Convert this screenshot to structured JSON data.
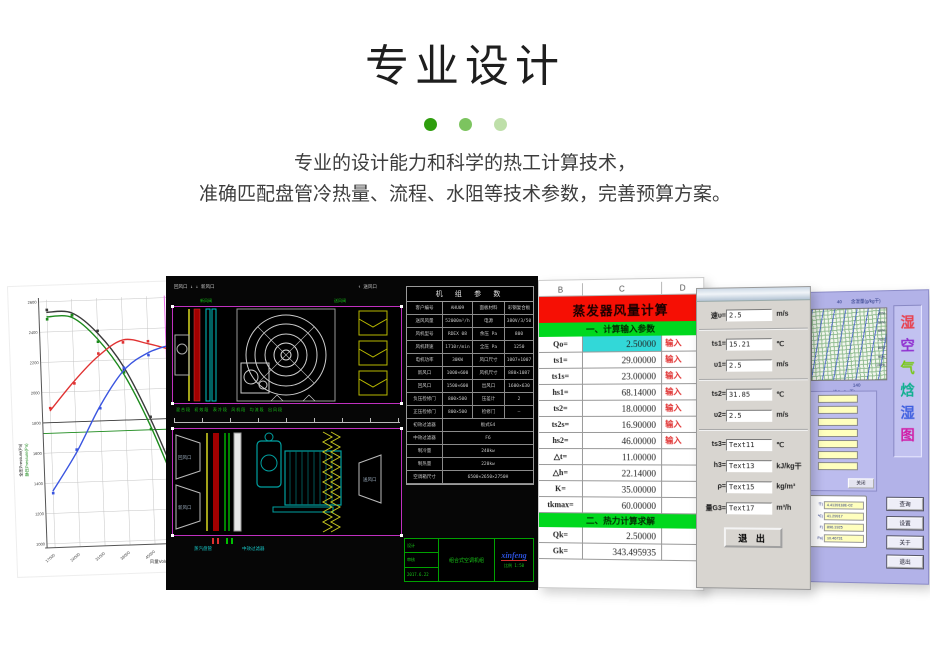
{
  "header": {
    "title": "专业设计",
    "dot_colors": [
      "#2f9e0e",
      "#7cc45f",
      "#bedfa9"
    ],
    "desc_line1": "专业的设计能力和科学的热工计算技术，",
    "desc_line2": "准确匹配盘管冷热量、流程、水阻等技术参数，完善预算方案。"
  },
  "chart_data": {
    "type": "line",
    "title": "风机性能曲线",
    "xlabel": "风量Volume(m³/h)",
    "ylabel_primary": "全压Pressure(Pa)",
    "ylabel_secondary": "静压Pressure(Pa)",
    "x": [
      17000,
      24000,
      31000,
      38000,
      45000,
      52000
    ],
    "x_tick_labels": [
      "17000",
      "24000",
      "31000",
      "38000",
      "45000",
      "52000"
    ],
    "ylim": [
      1000,
      2600
    ],
    "y_ticks": [
      1000,
      1200,
      1400,
      1600,
      1800,
      2000,
      2200,
      2400,
      2600
    ],
    "grid": true,
    "legend_position": "none",
    "series": [
      {
        "name": "全压",
        "color": "#3a3a3a",
        "values": [
          2530,
          2520,
          2380,
          2150,
          1800,
          1380
        ]
      },
      {
        "name": "静压",
        "color": "#1c8a1c",
        "values": [
          2500,
          2490,
          2340,
          2100,
          1750,
          1320
        ]
      },
      {
        "name": "功率",
        "color": "#e03232",
        "values": [
          1880,
          2070,
          2230,
          2330,
          2300,
          2250
        ]
      },
      {
        "name": "效率",
        "color": "#3a55e0",
        "values": [
          1350,
          1600,
          1900,
          2130,
          2240,
          2290
        ]
      }
    ],
    "ref_lines": {
      "horizontal": [
        {
          "y": 1800,
          "color": "#3a3a3a"
        },
        {
          "y": 1730,
          "color": "#1c8a1c"
        }
      ],
      "vertical": [
        {
          "x": 50000,
          "color": "#ea6ae8"
        }
      ]
    }
  },
  "cad": {
    "top_left_label": "回风口 ↓  ↓ 新风口",
    "top_right_label": "↑ 送风口",
    "valve_label_left": "新风阀",
    "valve_label_right": "送风阀",
    "sections_label": "混合段  初效段  表冷段  风机段  均流段  出风段",
    "inlet_label_top": "回风口",
    "inlet_label_bottom": "新风口",
    "outlet_label": "送风口",
    "bottom_label_1": "蒸汽盘管",
    "bottom_label_2": "中效过滤器",
    "table": {
      "title": "机 组 参 数",
      "rows4": [
        [
          "客户编号",
          "AHU09",
          "面板材料",
          "彩钢复合板"
        ],
        [
          "送风风量",
          "52000m³/h",
          "电源",
          "380V/3/50"
        ],
        [
          "风机型号",
          "RDEX 08",
          "余压 Pa",
          "800"
        ],
        [
          "风机转速",
          "1710r/min",
          "全压 Pa",
          "1250"
        ],
        [
          "电机功率",
          "30KW",
          "风口尺寸",
          "1007×1007"
        ],
        [
          "新风口",
          "1000×600",
          "风机尺寸",
          "880×1087"
        ],
        [
          "回风口",
          "1500×600",
          "出风口",
          "1600×630"
        ],
        [
          "负压检修门",
          "800×500",
          "压差计",
          "2"
        ],
        [
          "正压检修门",
          "800×500",
          "检修门",
          "—"
        ]
      ],
      "rows2": [
        [
          "初效过滤器",
          "板式G4"
        ],
        [
          "中效过滤器",
          "F6"
        ],
        [
          "制冷量",
          "240kw"
        ],
        [
          "制热量",
          "220kw"
        ],
        [
          "空调箱尺寸",
          "6500×2650×2750H"
        ]
      ]
    },
    "title_block": {
      "design": "设计",
      "check": "审核",
      "date": "2017.6.22",
      "name": "组合式空调机组",
      "logo": "xinfeng",
      "scale": "比例 1:50"
    }
  },
  "sheet": {
    "cols": [
      "B",
      "C",
      "D"
    ],
    "banner": "蒸发器风量计算",
    "section1": "一、计算输入参数",
    "section2": "二、热力计算求解",
    "rows1": [
      {
        "k": "Qo=",
        "v": "2.50000",
        "n": "输入",
        "hl": true
      },
      {
        "k": "ts1=",
        "v": "29.00000",
        "n": "输入"
      },
      {
        "k": "ts1s=",
        "v": "23.00000",
        "n": "输入"
      },
      {
        "k": "hs1=",
        "v": "68.14000",
        "n": "输入"
      },
      {
        "k": "ts2=",
        "v": "18.00000",
        "n": "输入"
      },
      {
        "k": "ts2s=",
        "v": "16.90000",
        "n": "输入"
      },
      {
        "k": "hs2=",
        "v": "46.00000",
        "n": "输入"
      },
      {
        "k": "△t=",
        "v": "11.00000",
        "n": ""
      },
      {
        "k": "△h=",
        "v": "22.14000",
        "n": ""
      },
      {
        "k": "K=",
        "v": "35.00000",
        "n": ""
      },
      {
        "k": "tkmax=",
        "v": "60.00000",
        "n": ""
      }
    ],
    "rows2": [
      {
        "k": "Qk=",
        "v": "2.50000",
        "n": ""
      },
      {
        "k": "Gk=",
        "v": "343.495935",
        "n": ""
      }
    ]
  },
  "form": {
    "fields": [
      {
        "l": "速υ=",
        "v": "2.5",
        "u": "m/s"
      },
      {
        "l": "ts1=",
        "v": "15.21",
        "u": "℃",
        "sep_before": true
      },
      {
        "l": "υ1=",
        "v": "2.5",
        "u": "m/s"
      },
      {
        "l": "ts2=",
        "v": "31.85",
        "u": "℃",
        "sep_before": true
      },
      {
        "l": "υ2=",
        "v": "2.5",
        "u": "m/s"
      },
      {
        "l": "ts3=",
        "v": "Text11",
        "u": "℃",
        "sep_before": true
      },
      {
        "l": "h3=",
        "v": "Text13",
        "u": "kJ/kg干"
      },
      {
        "l": "ρ=",
        "v": "Text15",
        "u": "kg/m³"
      },
      {
        "l": "量G3=",
        "v": "Text17",
        "u": "m³/h"
      }
    ],
    "exit_label": "退 出"
  },
  "psy": {
    "x40": "40",
    "humidity_label": "含湿量(g/kg干)",
    "pct_labels": [
      "40%",
      "50%",
      "60%",
      "70%",
      "80%",
      "90%",
      "100%"
    ],
    "x140": "140",
    "enthalpy_label": "焓(kJ/kg干)",
    "app_title_chars": [
      {
        "ch": "湿",
        "color": "#e8404e"
      },
      {
        "ch": "空",
        "color": "#9030d0"
      },
      {
        "ch": "气",
        "color": "#78c818"
      },
      {
        "ch": "焓",
        "color": "#10b090"
      },
      {
        "ch": "湿",
        "color": "#4060e0"
      },
      {
        "ch": "图",
        "color": "#d020a8"
      }
    ],
    "input_count": 7,
    "close_label": "关闭",
    "result_rows": [
      {
        "l": "干)",
        "v": "4.4139118E-02"
      },
      {
        "l": "℃)",
        "v": "41.29917"
      },
      {
        "l": "F)",
        "v": "896.1925"
      },
      {
        "l": "Pa)",
        "v": "10.46731"
      }
    ],
    "buttons": [
      "查询",
      "设置",
      "关于",
      "退出"
    ]
  }
}
